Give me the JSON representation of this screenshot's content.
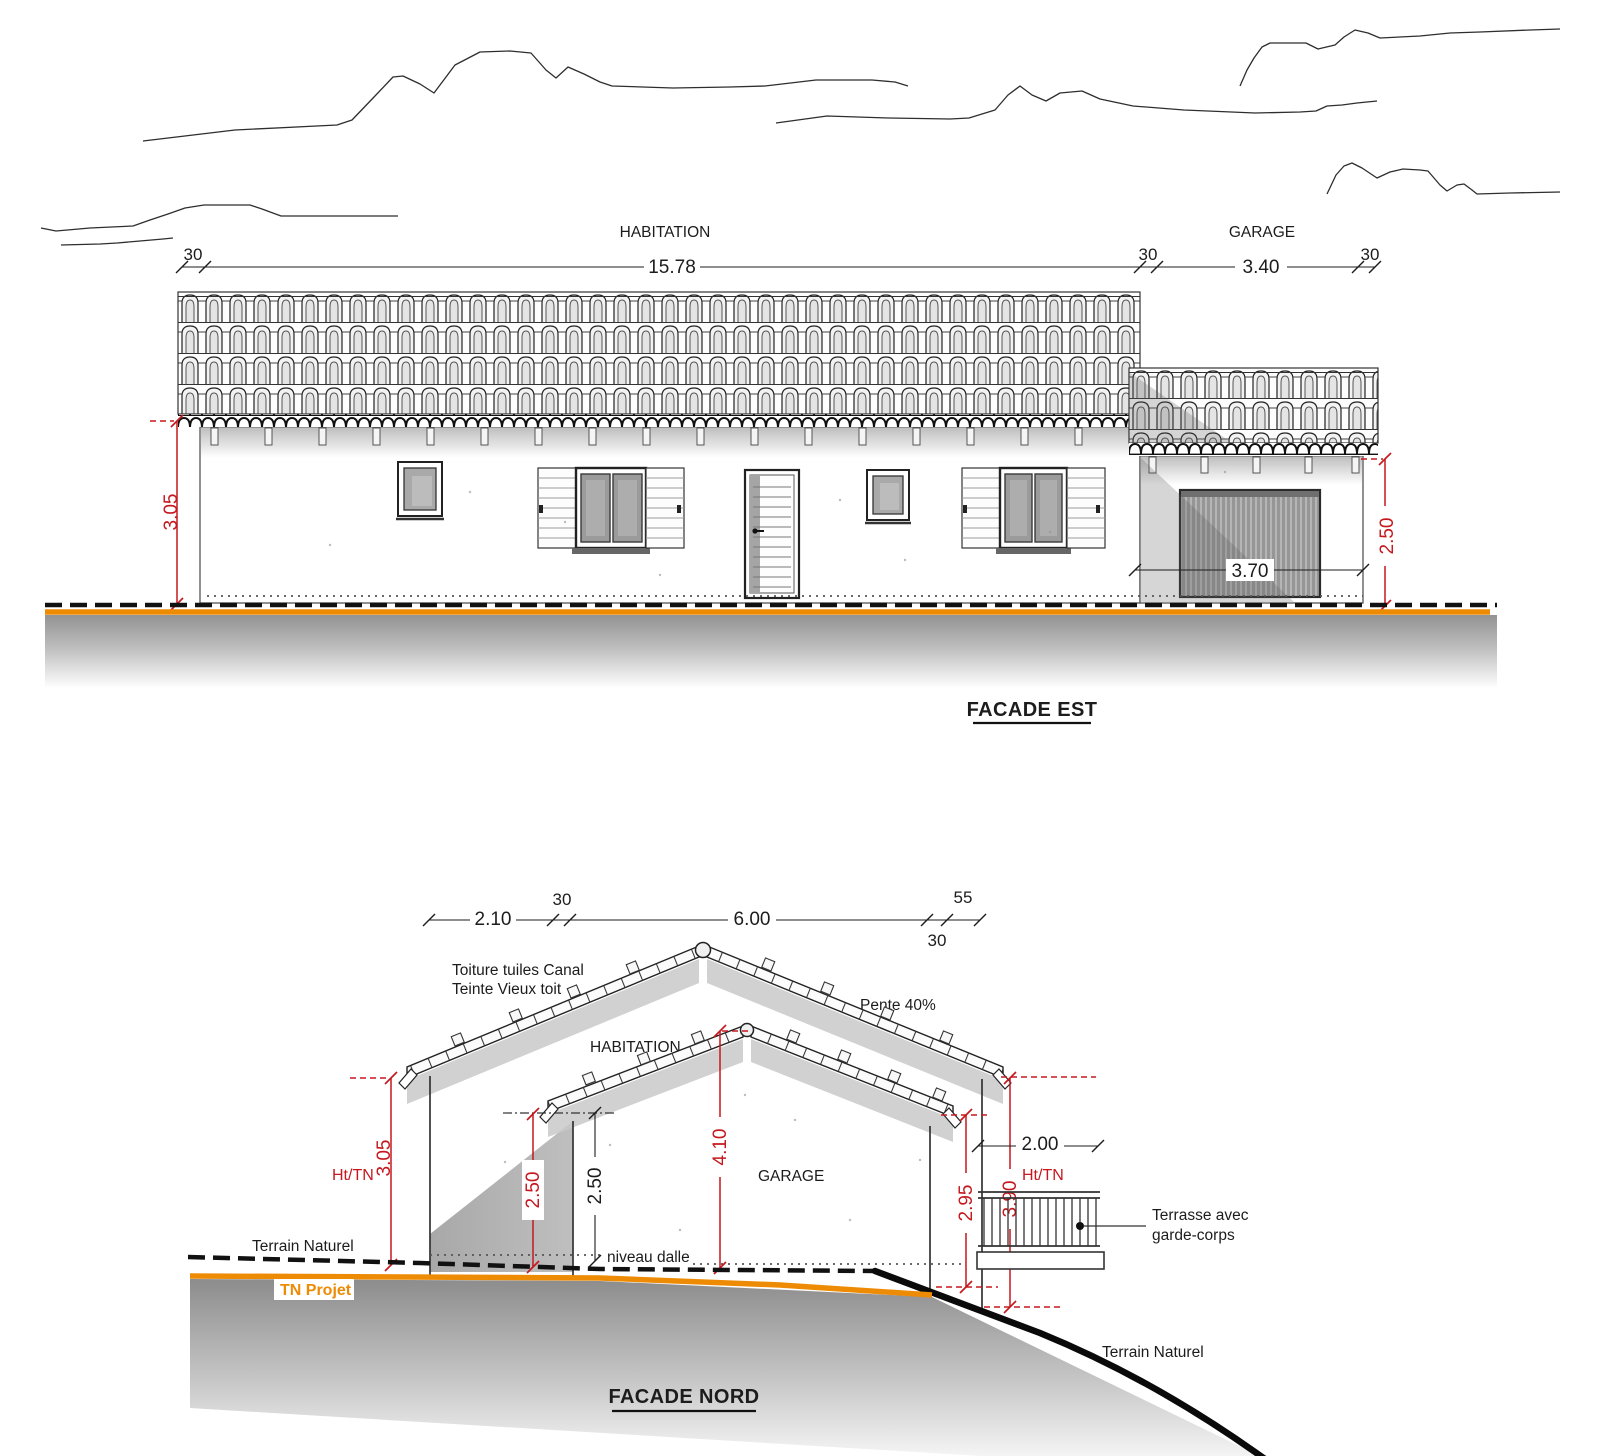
{
  "colors": {
    "red": "#c5181f",
    "orange": "#ee8b05"
  },
  "facade_est": {
    "title": "FACADE EST",
    "zone_labels": {
      "habitation": "HABITATION",
      "garage": "GARAGE"
    },
    "dims": {
      "edge_left": "30",
      "habitation_width": "15.78",
      "wall_mid": "30",
      "garage_width": "3.40",
      "edge_right": "30",
      "height_habitation": "3.05",
      "garage_opening_width": "3.70",
      "height_garage": "2.50"
    }
  },
  "facade_nord": {
    "title": "FACADE NORD",
    "dims": {
      "left_offset": "2.10",
      "wall_left": "30",
      "garage_span": "6.00",
      "wall_right": "30",
      "overhang_right": "55",
      "height_habitation": "3.05",
      "height_garage_red": "2.50",
      "height_garage_black": "2.50",
      "height_ridge": "4.10",
      "height_right_garage": "2.95",
      "height_right_terrace": "3.90",
      "terrace_width": "2.00"
    },
    "labels": {
      "roof_note_line1": "Toiture tuiles Canal",
      "roof_note_line2": "Teinte Vieux toit",
      "slope": "Pente 40%",
      "habitation": "HABITATION",
      "garage": "GARAGE",
      "ht_tn_left": "Ht/TN",
      "ht_tn_right": "Ht/TN",
      "terrain_naturel_left": "Terrain Naturel",
      "terrain_naturel_right": "Terrain Naturel",
      "tn_projet": "TN Projet",
      "niveau_dalle": "niveau dalle",
      "terrasse_line1": "Terrasse avec",
      "terrasse_line2": "garde-corps"
    }
  }
}
